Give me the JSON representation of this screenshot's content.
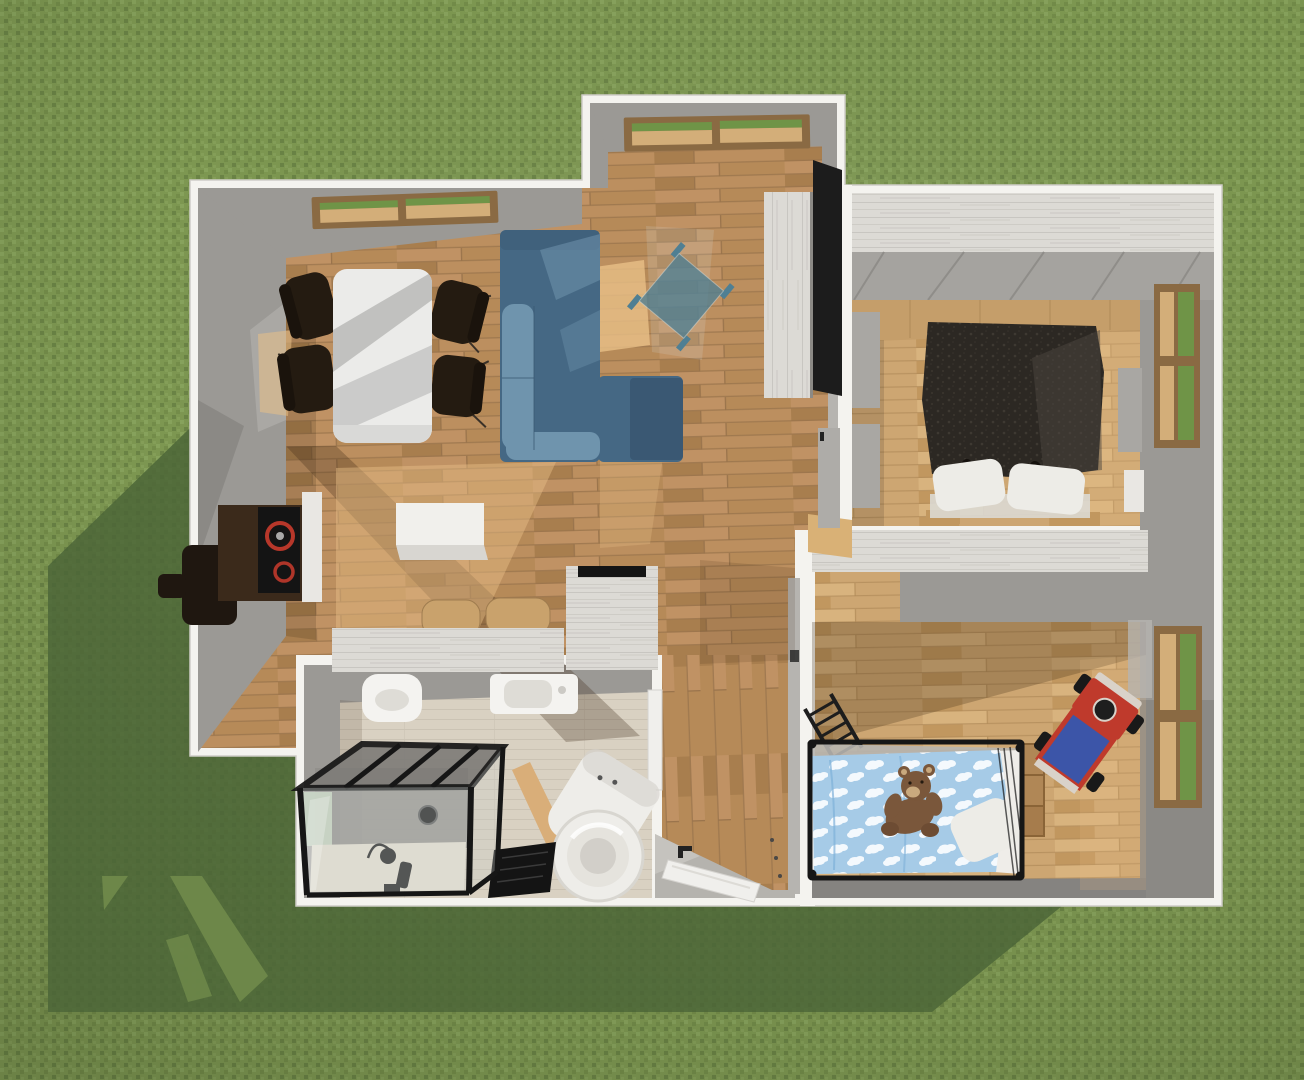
{
  "scene": {
    "title": "3D home floor plan — bird's-eye render",
    "style": "top-down 3D architectural visualization of a small house on a lawn",
    "environment": {
      "ground": "grass lawn",
      "lighting": "sunlight from upper right, house shadow cast to lower left"
    },
    "rooms": [
      {
        "name": "Living & dining room",
        "position": "left wing",
        "items": [
          "roof window",
          "bay window",
          "dining table",
          "four dining chairs",
          "L-shaped corner sofa",
          "glass coffee table",
          "wall TV panel",
          "plank sideboard"
        ]
      },
      {
        "name": "Kitchen",
        "position": "lower left wing",
        "items": [
          "dark counter with cooktop and red burners",
          "armchair stool",
          "white island block",
          "counter run with twin sink basins",
          "hob counter"
        ]
      },
      {
        "name": "Bathroom",
        "position": "bottom left",
        "items": [
          "black-framed walk-in glass shower",
          "shower column",
          "wall-hung toilet",
          "washbasin",
          "black bath mat",
          "washing machine",
          "wooden board"
        ]
      },
      {
        "name": "Hallway & entry",
        "position": "center",
        "items": [
          "entry step wedge",
          "white door mat",
          "bathroom door",
          "bedroom door",
          "nursery doorway threshold"
        ]
      },
      {
        "name": "Bedroom",
        "position": "top right",
        "items": [
          "double bed with dark duvet",
          "two white pillows",
          "wardrobe panels",
          "nightstand",
          "four-pane window"
        ]
      },
      {
        "name": "Nursery",
        "position": "bottom right",
        "items": [
          "black-framed cot with cloud-pattern bedding",
          "teddy bear",
          "white pillow",
          "ladder",
          "toy crate",
          "red and blue toy truck",
          "four-pane window"
        ]
      }
    ]
  },
  "palette": {
    "grass1": "#7d9751",
    "grass2": "#87a25c",
    "grass3": "#738c49",
    "grass4": "#6a8345",
    "shadowGreen": "#4b6437",
    "slitGreen": "#6d8749",
    "wallWhite": "#f4f3ef",
    "wallOutline": "#cfcdc8",
    "faceGray": "#9b9995",
    "faceGrayDark": "#858380",
    "faceGrayLight": "#b6b4b0",
    "plankWhite": "#dcdad5",
    "plankSeam": "#c8c6c1",
    "plankStreak": "#d2d0cb",
    "slopeGray": "#a5a39f",
    "slopeSeam": "#8f8d89",
    "wood1": "#b68a58",
    "wood2": "#c09264",
    "wood3": "#a87e4e",
    "woodSeam": "#9a744c",
    "woodL1": "#cda672",
    "woodL2": "#d8b37e",
    "woodL3": "#c1975f",
    "woodLSeam": "#b08a58",
    "bathFloor": "#d9d1c2",
    "bathSeam": "#cbc3b4",
    "tray": "#eae3d4",
    "tanWall": "#c59e6a",
    "tanWallSeam": "#b18c5a",
    "frameWood": "#8a6a43",
    "paneGreen": "#6f9447",
    "paneTan": "#d3ae79",
    "paneLight": "#cfe0c8",
    "tableTop": "#ebebe9",
    "tableStripe": "#bcbcba",
    "tableStripe2": "#c6c6c4",
    "chairDark": "#241b11",
    "chairLeg": "#3a3128",
    "sofaMid": "#456884",
    "sofaLight": "#6f94ad",
    "sofaDark": "#3a5873",
    "glassTeal": "#4f7f93",
    "glassSheet": "#d7e8ee",
    "tvBlack": "#1c1c1c",
    "cabinetEdge": "#8c8a86",
    "counterBrown": "#3b2a1b",
    "stoolDark": "#1f1710",
    "cooktopBlack": "#141414",
    "burnerRed": "#c0392b",
    "islandWhite": "#f1f0ec",
    "islandShade": "#d8d6d1",
    "sinkTan": "#c9a26c",
    "sinkEdge": "#9f7c4f",
    "fixtureWhite": "#f4f3f0",
    "fixtureInner": "#dedcd6",
    "doorWhite": "#f0efec",
    "doorEdge": "#d5d3cf",
    "showerFrame": "#161616",
    "showerTop": "#7f7d79",
    "showerBack": "#918f8b",
    "showerGlass": "#c9cdca",
    "matBlack": "#141414",
    "matLine": "#3a3a3a",
    "washerWhite": "#eeede9",
    "washerShade": "#d3d1cb",
    "washerRim": "#d8d6d0",
    "drumMid": "#e5e3dd",
    "drumDark": "#d2cfc9",
    "boardTan": "#d9ae79",
    "duvet": "#2c2823",
    "duvetDot": "#3e3932",
    "duvetFold": "#4b463f",
    "pillowWhite": "#edece7",
    "sheetWhite": "#dcd9d3",
    "cribBlue": "#a6cbe7",
    "cloudWhite": "#f4f9fd",
    "cribFold": "#7fb0d8",
    "cribFrame": "#161616",
    "mattress": "#efede9",
    "railGray": "#b7b5b0",
    "teddy": "#7a573b",
    "teddyDark": "#6d4c33",
    "teddyLight": "#c9a97e",
    "eyeDark": "#241a10",
    "truckRed": "#bf3a2c",
    "truckBlue": "#3c55a8",
    "truckLight": "#d9d2c9",
    "wheelBlack": "#191919",
    "thresholdTan": "#d9b176",
    "doorGray": "#aeaca8",
    "panelGray": "#a9a7a3",
    "nightstand": "#e9e7e3",
    "lightPatch": "#e8bf87",
    "shadowPatch": "#3a2511",
    "dotGray": "#4a4846",
    "handleDark": "#222222"
  }
}
